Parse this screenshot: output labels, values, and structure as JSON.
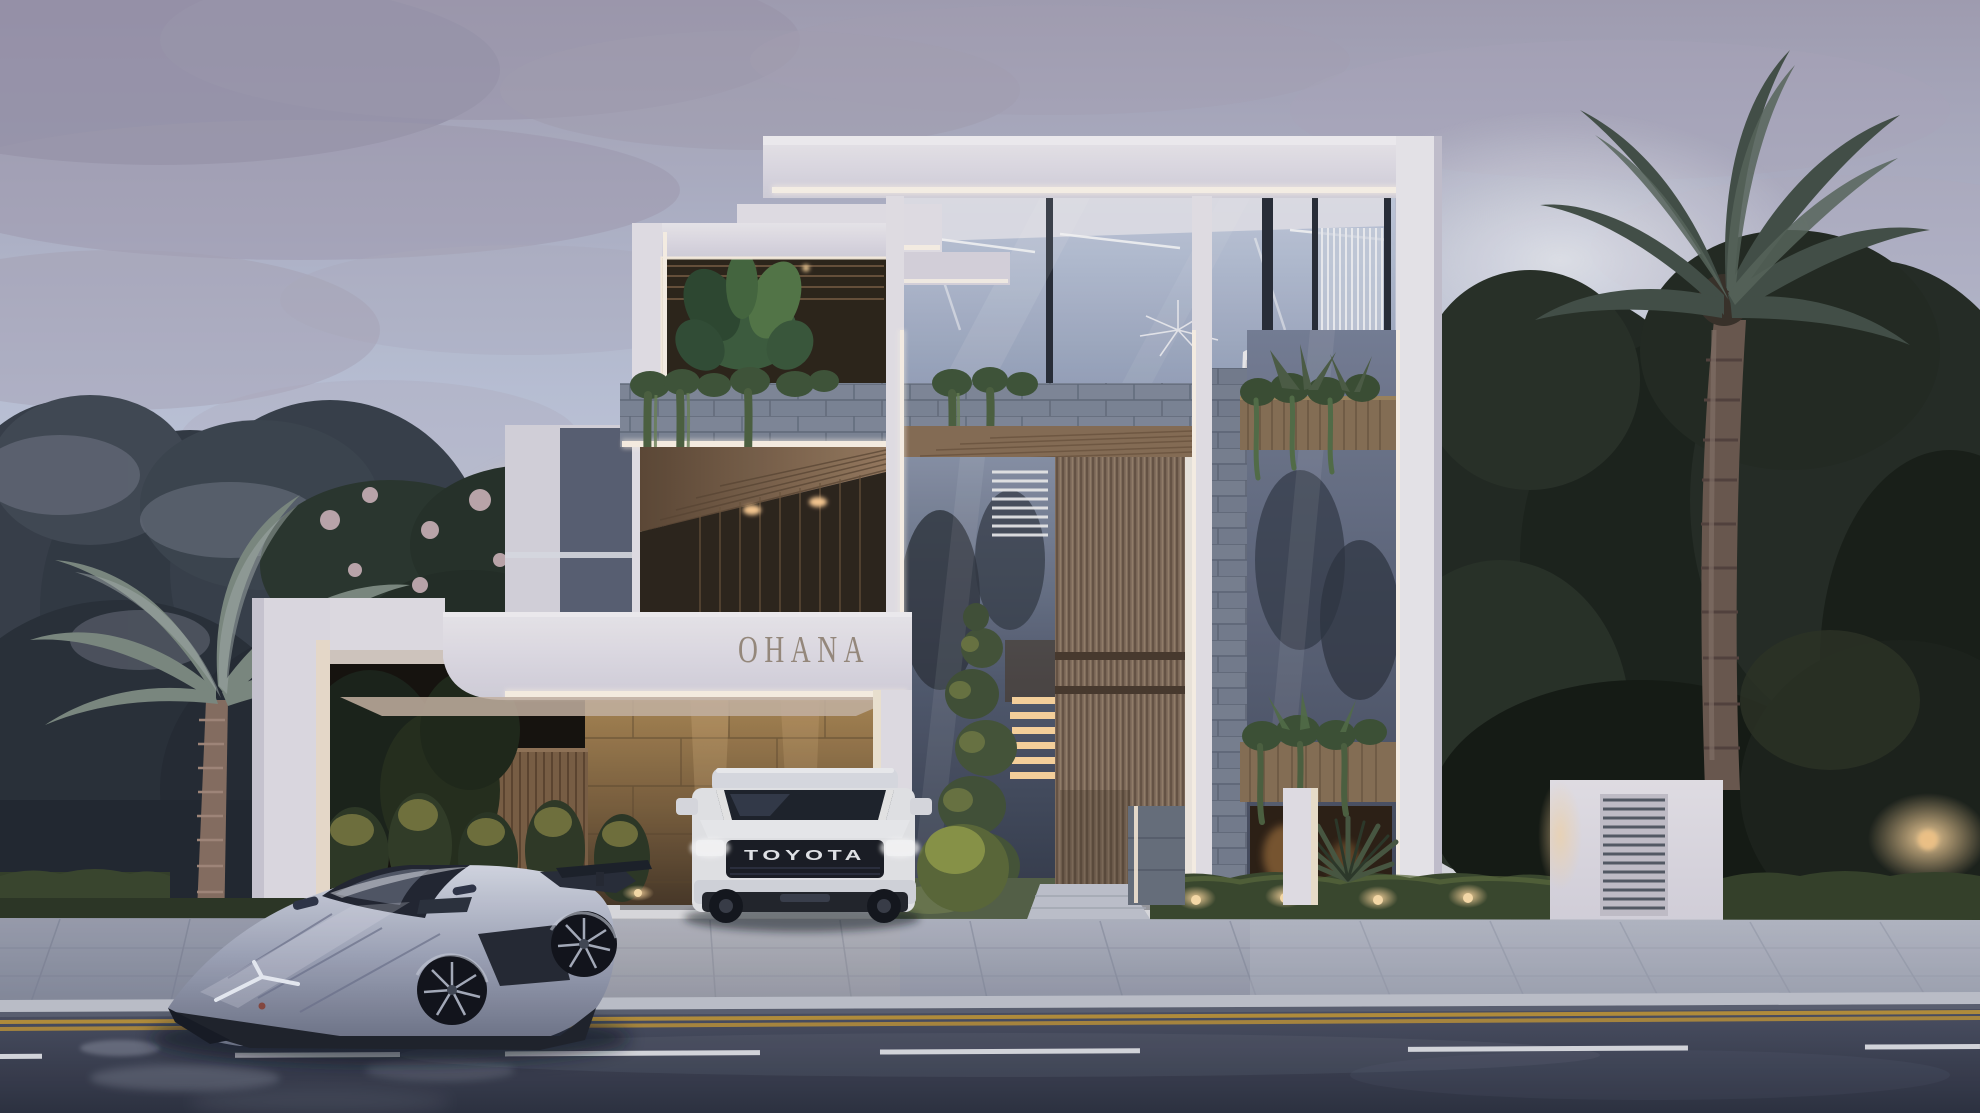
{
  "scene": {
    "title": "Modern three-storey luxury villa exterior at dusk",
    "sign_text": "OHANA",
    "setting": "Tropical residential street, palms and dense trees, wet asphalt road in foreground"
  },
  "vehicles": {
    "suv": {
      "type": "white SUV parked in gated driveway",
      "badge": "TOYOTA",
      "body_color": "#e9eaee"
    },
    "supercar": {
      "type": "silver angular supercar on street",
      "body_color": "#a9afc4"
    }
  },
  "palette": {
    "sky_top": "#a39fb4",
    "sky_mid": "#c7cfe3",
    "sunset_glow": "#ecd9c4",
    "cloud": "#9b96ad",
    "wall_white": "#eae7ee",
    "led_white": "#fff7ec",
    "sign_bronze": "#9b8e81",
    "wood_slats": "#84705f",
    "wood_soffit": "#8a6f55",
    "travertine_lit": "#a8854f",
    "stone_cladding": "#8a93a5",
    "glass_light": "#c3cde0",
    "glass_dark": "#3c4354",
    "foliage_dark": "#20271f",
    "foliage_frost": "#97a0ae",
    "blossom_pink": "#dcc0c8",
    "hedge_green": "#3c4a30",
    "grass_green": "#57644a",
    "uplight_warm": "#e8b86a",
    "paver_gray": "#a9aebc",
    "road_asphalt": "#3d4255",
    "lane_yellow": "#b8923e",
    "lane_white": "#dcdee4"
  }
}
